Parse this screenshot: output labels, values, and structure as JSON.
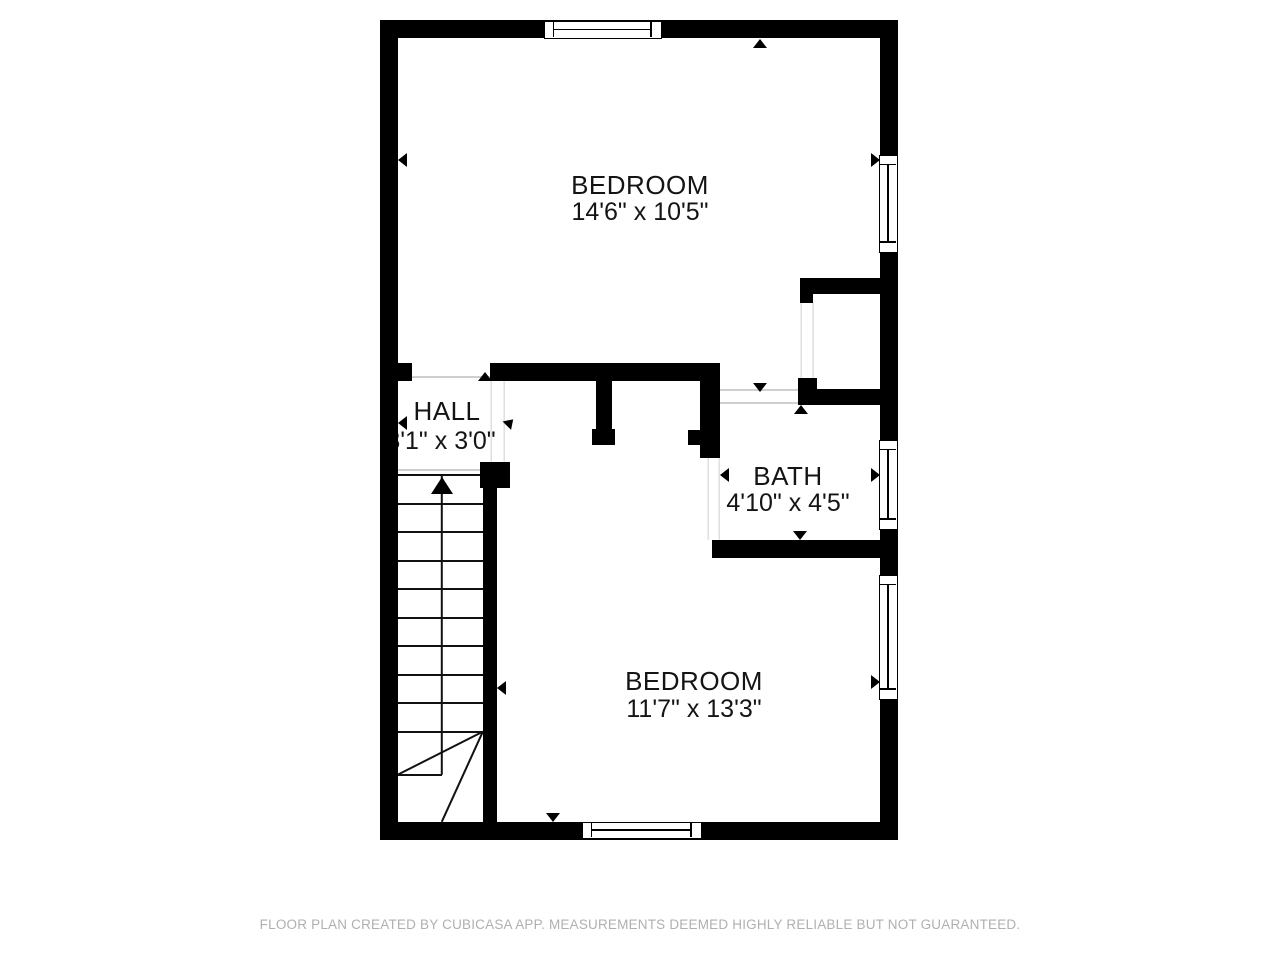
{
  "footer": {
    "text": "FLOOR PLAN CREATED BY CUBICASA APP. MEASUREMENTS DEEMED HIGHLY RELIABLE BUT NOT GUARANTEED."
  },
  "colors": {
    "wall": "#000000",
    "text": "#141414",
    "opening_line": "#cfcfcf",
    "stair_line": "#111111",
    "footer_text": "#b0b0b0",
    "background": "#ffffff"
  },
  "rooms": [
    {
      "name": "BEDROOM",
      "dims": "14'6\" x 10'5\"",
      "cx": 640,
      "name_y": 172,
      "dims_y": 200
    },
    {
      "name": "HALL",
      "dims": "3'1\" x 3'0\"",
      "cx": 447,
      "dims_cx": 441,
      "name_y": 398,
      "dims_y": 429
    },
    {
      "name": "BATH",
      "dims": "4'10\" x 4'5\"",
      "cx": 788,
      "name_y": 463,
      "dims_y": 491
    },
    {
      "name": "BEDROOM",
      "dims": "11'7\" x 13'3\"",
      "cx": 694,
      "name_y": 668,
      "dims_y": 697
    }
  ],
  "structure": {
    "walls": [
      {
        "x": 380,
        "y": 20,
        "w": 518,
        "h": 18
      },
      {
        "x": 380,
        "y": 20,
        "w": 18,
        "h": 820
      },
      {
        "x": 880,
        "y": 20,
        "w": 18,
        "h": 820
      },
      {
        "x": 380,
        "y": 822,
        "w": 518,
        "h": 18
      },
      {
        "x": 398,
        "y": 363,
        "w": 14,
        "h": 18
      },
      {
        "x": 490,
        "y": 363,
        "w": 230,
        "h": 18
      },
      {
        "x": 596,
        "y": 379,
        "w": 16,
        "h": 52
      },
      {
        "x": 592,
        "y": 429,
        "w": 23,
        "h": 16
      },
      {
        "x": 700,
        "y": 379,
        "w": 20,
        "h": 79
      },
      {
        "x": 688,
        "y": 430,
        "w": 12,
        "h": 15
      },
      {
        "x": 800,
        "y": 278,
        "w": 80,
        "h": 16
      },
      {
        "x": 800,
        "y": 294,
        "w": 13,
        "h": 9
      },
      {
        "x": 798,
        "y": 378,
        "w": 19,
        "h": 27
      },
      {
        "x": 798,
        "y": 389,
        "w": 82,
        "h": 16
      },
      {
        "x": 712,
        "y": 540,
        "w": 186,
        "h": 18
      },
      {
        "x": 480,
        "y": 462,
        "w": 30,
        "h": 26
      },
      {
        "x": 483,
        "y": 487,
        "w": 14,
        "h": 335
      }
    ],
    "windows": [
      {
        "x": 544,
        "y": 21,
        "w": 118,
        "h": 18,
        "o": "h"
      },
      {
        "x": 879,
        "y": 155,
        "w": 19,
        "h": 98,
        "o": "v"
      },
      {
        "x": 879,
        "y": 440,
        "w": 19,
        "h": 90,
        "o": "v"
      },
      {
        "x": 879,
        "y": 575,
        "w": 19,
        "h": 125,
        "o": "v"
      },
      {
        "x": 582,
        "y": 822,
        "w": 120,
        "h": 17,
        "o": "h"
      }
    ],
    "opening_lines": [
      {
        "x1": 412,
        "y1": 377,
        "x2": 490,
        "y2": 377
      },
      {
        "x1": 398,
        "y1": 470,
        "x2": 480,
        "y2": 470
      },
      {
        "x1": 491,
        "y1": 381,
        "x2": 491,
        "y2": 462
      },
      {
        "x1": 504,
        "y1": 381,
        "x2": 504,
        "y2": 462
      },
      {
        "x1": 720,
        "y1": 390,
        "x2": 798,
        "y2": 390
      },
      {
        "x1": 720,
        "y1": 403,
        "x2": 798,
        "y2": 403
      },
      {
        "x1": 708,
        "y1": 458,
        "x2": 708,
        "y2": 540
      },
      {
        "x1": 719,
        "y1": 458,
        "x2": 719,
        "y2": 540
      },
      {
        "x1": 801,
        "y1": 303,
        "x2": 801,
        "y2": 380
      },
      {
        "x1": 813,
        "y1": 303,
        "x2": 813,
        "y2": 380
      }
    ],
    "arrows": [
      {
        "x": 760,
        "y": 39,
        "d": "up"
      },
      {
        "x": 398,
        "y": 160,
        "d": "left"
      },
      {
        "x": 880,
        "y": 160,
        "d": "right"
      },
      {
        "x": 485,
        "y": 372,
        "d": "up"
      },
      {
        "x": 553,
        "y": 372,
        "d": "up"
      },
      {
        "x": 760,
        "y": 392,
        "d": "down"
      },
      {
        "x": 801,
        "y": 405,
        "d": "up"
      },
      {
        "x": 720,
        "y": 475,
        "d": "left"
      },
      {
        "x": 880,
        "y": 475,
        "d": "right"
      },
      {
        "x": 800,
        "y": 540,
        "d": "down"
      },
      {
        "x": 497,
        "y": 688,
        "d": "left"
      },
      {
        "x": 880,
        "y": 682,
        "d": "right"
      },
      {
        "x": 553,
        "y": 822,
        "d": "down"
      },
      {
        "x": 480,
        "y": 472,
        "d": "left"
      },
      {
        "x": 398,
        "y": 423,
        "d": "left"
      },
      {
        "x": 510,
        "y": 418,
        "d": "ne"
      }
    ],
    "stairs": {
      "lines": [
        {
          "x1": 398,
          "y1": 475,
          "x2": 483,
          "y2": 475
        },
        {
          "x1": 398,
          "y1": 504,
          "x2": 483,
          "y2": 504
        },
        {
          "x1": 398,
          "y1": 532,
          "x2": 483,
          "y2": 532
        },
        {
          "x1": 398,
          "y1": 561,
          "x2": 483,
          "y2": 561
        },
        {
          "x1": 398,
          "y1": 589,
          "x2": 483,
          "y2": 589
        },
        {
          "x1": 398,
          "y1": 618,
          "x2": 483,
          "y2": 618
        },
        {
          "x1": 398,
          "y1": 646,
          "x2": 483,
          "y2": 646
        },
        {
          "x1": 398,
          "y1": 675,
          "x2": 483,
          "y2": 675
        },
        {
          "x1": 398,
          "y1": 703,
          "x2": 483,
          "y2": 703
        },
        {
          "x1": 398,
          "y1": 732,
          "x2": 483,
          "y2": 732
        },
        {
          "x1": 398,
          "y1": 775,
          "x2": 442,
          "y2": 775
        },
        {
          "x1": 442,
          "y1": 475,
          "x2": 442,
          "y2": 775
        },
        {
          "x1": 483,
          "y1": 732,
          "x2": 398,
          "y2": 775
        },
        {
          "x1": 483,
          "y1": 732,
          "x2": 442,
          "y2": 822
        }
      ],
      "arrow": {
        "x": 442,
        "y": 477
      }
    }
  }
}
